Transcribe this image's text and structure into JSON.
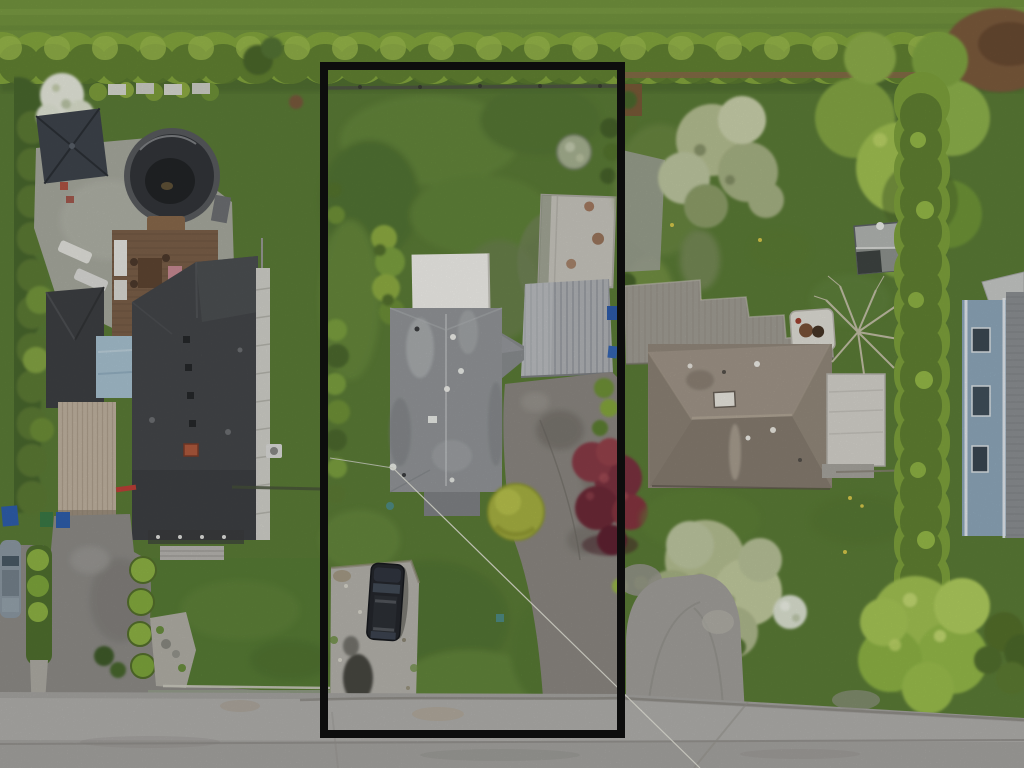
{
  "scene": {
    "kind": "aerial-drone-photograph",
    "subject": "three suburban residential lots viewed top-down; centre lot outlined in black; street along the bottom",
    "overlay_label": "highlighted-lot-boundary"
  },
  "colors": {
    "boundary": "#0d0d0d",
    "grass_base": "#5c7d37",
    "grass_light": "#74953f",
    "hedge": "#85a83e",
    "hedge_dark": "#4e672b",
    "dirt": "#7d5c3c",
    "road": "#a7a5a2",
    "road_light": "#b4b2af",
    "left_roof": "#45474a",
    "blue_roof": "#a9c3d2",
    "carport_roof": "#c2b4a2",
    "patio_gravel": "#a9aba0",
    "pool_cover": "#33363a",
    "gazebo_canopy": "#3f454d",
    "deck_wood": "#7c6049",
    "center_roof": "#94979a",
    "metal_roof": "#b2b5b8",
    "white_roof": "#f4f3ee",
    "concrete_pad": "#cac8c0",
    "driveway": "#8d8983",
    "driveway_right": "#a3a19c",
    "gravel_pad": "#b7b5ae",
    "van_body": "#24272c",
    "red_maple": "#7c3140",
    "yellow_bush": "#a9b342",
    "right_roof": "#93897c",
    "right_roof_white": "#d7d5ce",
    "deck_gray": "#a29e95",
    "hot_tub": "#e2e0d8",
    "pale_tree": "#b7c193",
    "lime_tree": "#a3c353",
    "blue_house_wall": "#8fa9bc",
    "blue_house_roof": "#8d9194",
    "car_silver": "#8d9aa4",
    "bin_blue": "#2f5fae",
    "power_line": "#e8e8dd"
  }
}
